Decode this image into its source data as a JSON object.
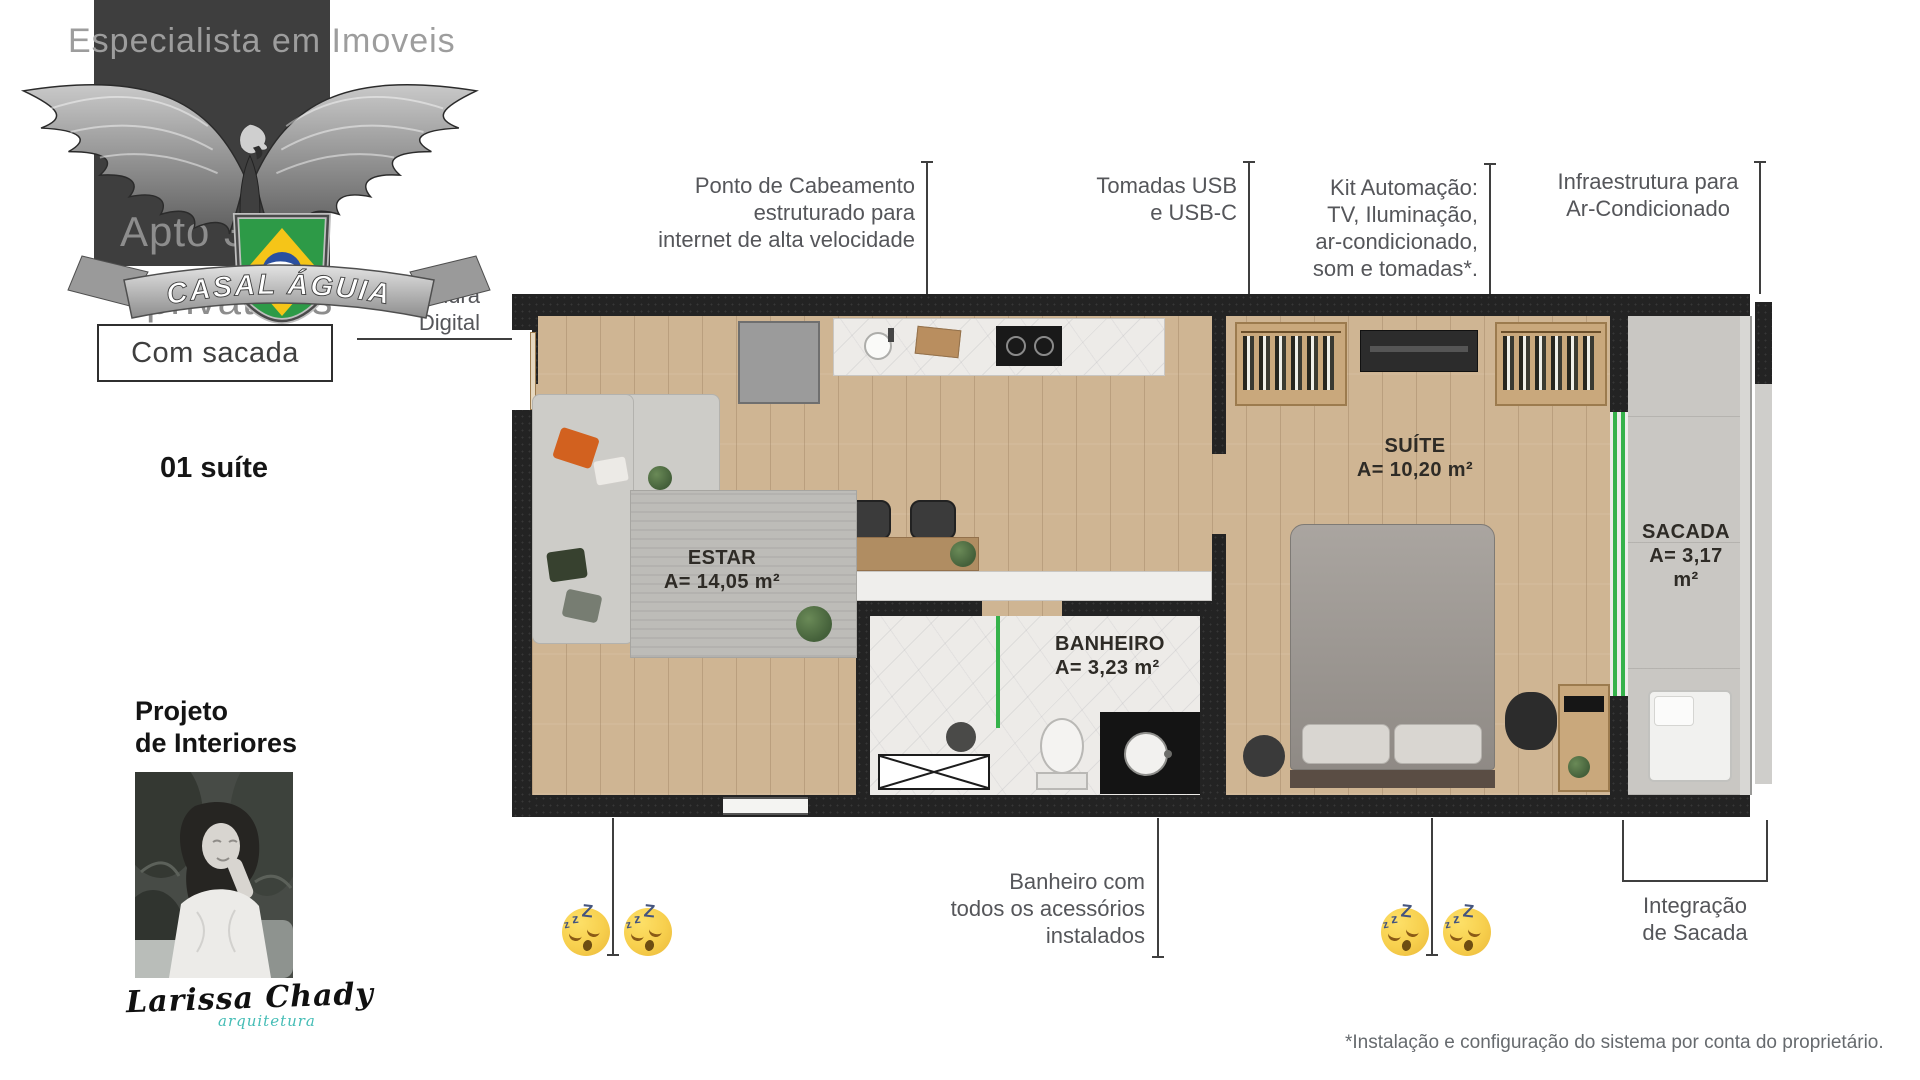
{
  "branding": {
    "watermark": "Especialista em Imoveis",
    "ribbon_text": "CASAL ÁGUIA",
    "apto_text": "Apto 35m²",
    "apto_text2": "privativos",
    "badge": "Com sacada",
    "suites_line": "01 suíte",
    "project_line1": "Projeto",
    "project_line2": "de Interiores",
    "signature_name": "Larissa Chady",
    "signature_role": "arquitetura"
  },
  "callouts": {
    "fechadura": {
      "lines": [
        "Fechadura",
        "Digital"
      ]
    },
    "cabeamento": {
      "lines": [
        "Ponto de Cabeamento",
        "estruturado para",
        "internet de alta velocidade"
      ]
    },
    "tomadas": {
      "lines": [
        "Tomadas USB",
        "e USB-C"
      ]
    },
    "automacao": {
      "lines": [
        "Kit Automação:",
        "TV, Iluminação,",
        "ar-condicionado,",
        "som e tomadas*."
      ]
    },
    "infraestrutura": {
      "lines": [
        "Infraestrutura para",
        "Ar-Condicionado"
      ]
    },
    "banheiro_acessorios": {
      "lines": [
        "Banheiro com",
        "todos os acessórios",
        "instalados"
      ]
    },
    "integracao": {
      "lines": [
        "Integração",
        "de Sacada"
      ]
    }
  },
  "rooms": {
    "estar": {
      "name": "ESTAR",
      "area": "A= 14,05 m²"
    },
    "banheiro": {
      "name": "BANHEIRO",
      "area": "A= 3,23 m²"
    },
    "suite": {
      "name": "SUÍTE",
      "area": "A= 10,20 m²"
    },
    "sacada": {
      "name": "SACADA",
      "area": "A= 3,17 m²"
    }
  },
  "footnote": "*Instalação e configuração do sistema por conta do proprietário.",
  "icons": {
    "sleep_z_small": "z",
    "sleep_z_big": "Z"
  },
  "colors": {
    "accent_green": "#35B24A",
    "signature_teal": "#45BDB6",
    "callout_text": "#55565A",
    "wall": "#232323",
    "wood_floor": "#CFB593",
    "emoji_face": "#F7CF4D",
    "emoji_z": "#44547E"
  }
}
